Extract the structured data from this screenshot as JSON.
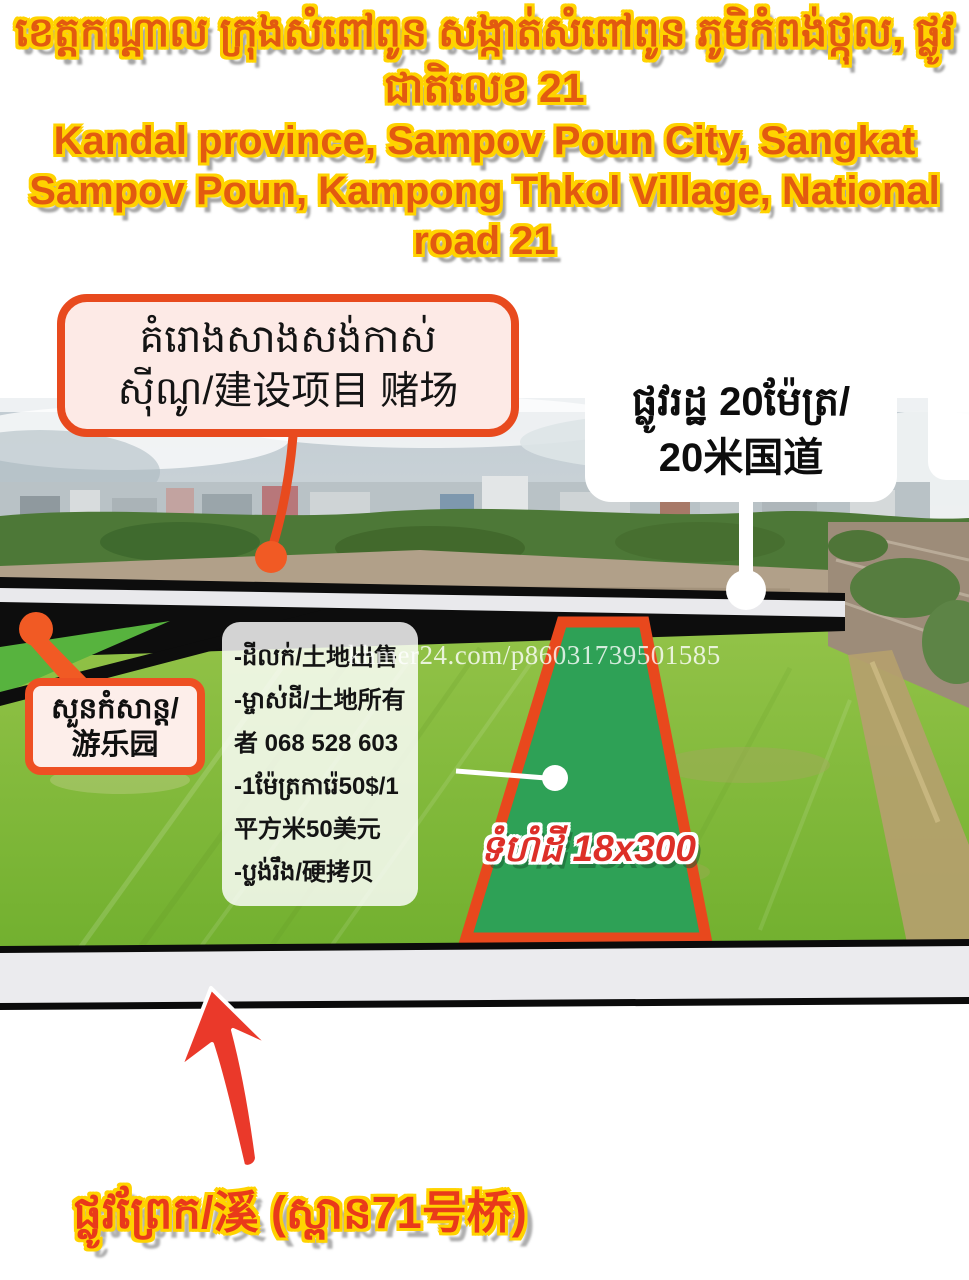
{
  "header": {
    "title_km_lines": [
      "ខេត្តកណ្តាល ក្រុងសំពៅពូន សង្កាត់សំពៅពូន ភូមិកំពង់ថ្កុល, ផ្លូវ",
      "ជាតិលេខ 21"
    ],
    "title_en_lines": [
      "Kandal province, Sampov Poun City, Sangkat",
      "Sampov Poun, Kampong Thkol Village, National",
      "road 21"
    ]
  },
  "callouts": {
    "casino": {
      "lines": [
        "គំរោងសាងសង់កាស់",
        "ស៊ីណូ/建设项目 赌场"
      ]
    },
    "main_road": {
      "lines": [
        "ផ្លូវរដ្ឋ 20ម៉ែត្រ/",
        "20米国道"
      ]
    },
    "amusement_park": {
      "lines": [
        "សួនកំសាន្ត/",
        "游乐园"
      ]
    }
  },
  "info_box": {
    "lines": [
      "-ដីលក់/土地出售",
      "-ម្ចាស់ដី/土地所有",
      "者 068 528 603",
      "-1ម៉ែត្រការ៉េ50$/1",
      "平方米50美元",
      "-ប្លង់រឹង/硬拷贝"
    ],
    "phone": "068 528 603"
  },
  "parcel": {
    "label": "ទំហំដី 18x300",
    "size": "18x300"
  },
  "watermark": "khmer24.com/p86031739501585",
  "footer": {
    "label": "ផ្លូវព្រែក/溪 (ស្ពាន71号桥)"
  },
  "colors": {
    "accent_orange": "#e8491f",
    "outline_yellow": "#ffd300",
    "title_orange": "#e25a10",
    "parcel_green": "#2ea156",
    "field_green": "#7eb838",
    "arrow_red": "#ea392a",
    "road_black": "#0d0d0d",
    "band_gray": "#ebebee"
  }
}
